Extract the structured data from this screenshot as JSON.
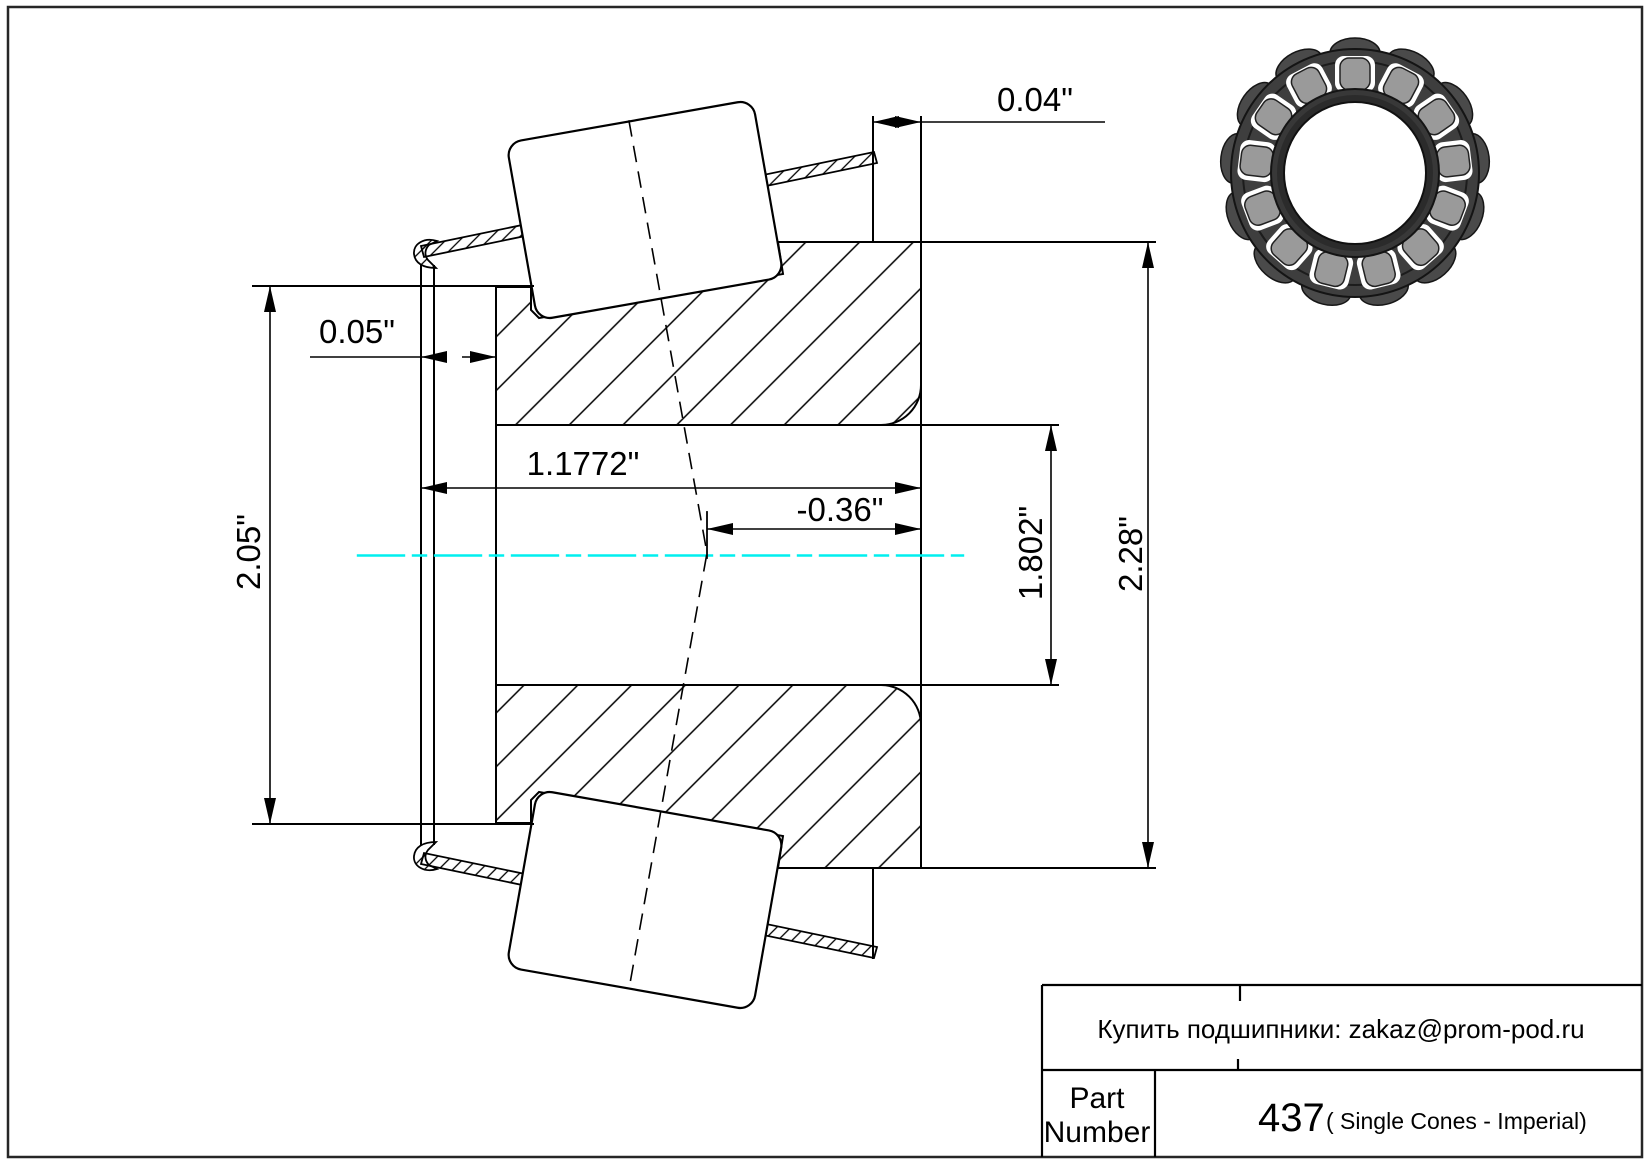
{
  "drawing": {
    "dims": {
      "backface_offset": "0.04\"",
      "lip_clearance": "0.05\"",
      "overall_width": "1.1772\"",
      "effective_center": "-0.36\"",
      "bore_diameter": "1.802\"",
      "outer_diameter": "2.28\"",
      "flange_diameter": "2.05\""
    },
    "centerline_color": "#00efef"
  },
  "photo": {
    "ring_color": "#3e3e3e",
    "roller_color": "#9a9a9a"
  },
  "title_block": {
    "contact": "Купить подшипники: zakaz@prom-pod.ru",
    "part_label_line1": "Part",
    "part_label_line2": "Number",
    "part_number": "437",
    "part_series": "( Single Cones - Imperial)"
  }
}
